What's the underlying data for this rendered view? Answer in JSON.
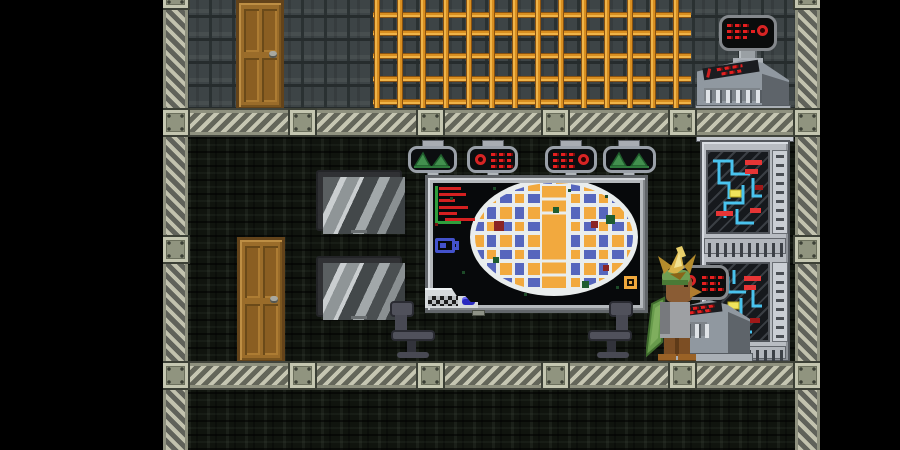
{
  "window": {
    "kind": "pixel-art sandbox game scene",
    "scene_label": "Space station interior with planetary map room",
    "canvas": {
      "width": 900,
      "height": 450
    }
  },
  "palette": {
    "space_black": "#000000",
    "hull_wall_gray": "#3d4446",
    "cave_rock_dark": "#10140e",
    "beam_stripe_light": "#c6c6b2",
    "beam_stripe_dark": "#64665a",
    "rivet_plate_gray": "#90947f",
    "lattice_copper": "#d88e20",
    "lattice_highlight": "#f0b448",
    "door_wood": "#9a6c2a",
    "map_frame_gray": "#b4b8bc",
    "planet_orange": "#f2a93e",
    "planet_blue": "#5666bd",
    "planet_rim_white": "#e9eded",
    "display_red": "#e41f1f",
    "display_green": "#42904e",
    "circuit_blue": "#49c3ee",
    "circuit_yellow": "#f0e45c",
    "chair_slate": "#484953",
    "npc_gold_plume": "#d9b349",
    "npc_green_cape": "#689b4c",
    "npc_brown_skin": "#8a5c34"
  },
  "entities": [
    {
      "name": "hull-wall",
      "label": "Hull plating wall (upper deck)",
      "interactable": false
    },
    {
      "name": "cave-wall-room",
      "label": "Dark rock wall (map room)",
      "interactable": false
    },
    {
      "name": "cave-wall-basement",
      "label": "Dark rock wall (lower level)",
      "interactable": false
    },
    {
      "name": "beam-upper",
      "label": "Riveted support beam (upper floor)",
      "interactable": false
    },
    {
      "name": "beam-lower",
      "label": "Riveted support beam (lower floor)",
      "interactable": false
    },
    {
      "name": "column-left",
      "label": "Support column (left)",
      "interactable": false
    },
    {
      "name": "column-right",
      "label": "Support column (right)",
      "interactable": false
    },
    {
      "name": "lattice-grid",
      "label": "Copper lattice grid",
      "interactable": false
    },
    {
      "name": "door-upper",
      "label": "Wooden door (upper deck)",
      "interactable": true
    },
    {
      "name": "door-lower",
      "label": "Wooden door (map room)",
      "interactable": true
    },
    {
      "name": "monitor-upper",
      "label": "Wall monitor (upper)",
      "interactable": false
    },
    {
      "name": "monitor-lower",
      "label": "Wall monitor (lower)",
      "interactable": false
    },
    {
      "name": "map-display",
      "label": "Planetary survey map display",
      "interactable": true
    },
    {
      "name": "pod-green-left",
      "label": "Scanner pod - green waveform (far left)",
      "interactable": false
    },
    {
      "name": "pod-red-left",
      "label": "Scanner pod - red readout (inner left)",
      "interactable": false
    },
    {
      "name": "pod-red-right",
      "label": "Scanner pod - red readout (inner right)",
      "interactable": false
    },
    {
      "name": "pod-green-right",
      "label": "Scanner pod - green waveform (far right)",
      "interactable": false
    },
    {
      "name": "console-upper",
      "label": "Computer console with red readout (upper deck)",
      "interactable": true
    },
    {
      "name": "console-lower",
      "label": "Computer console with red readout (map room)",
      "interactable": true
    },
    {
      "name": "server-rack",
      "label": "Server rack with blue circuitry",
      "interactable": false
    },
    {
      "name": "chair-left",
      "label": "Office chair (left, facing right)",
      "interactable": true
    },
    {
      "name": "chair-right",
      "label": "Office chair (right, facing left)",
      "interactable": true
    },
    {
      "name": "avian-npc",
      "label": "Avian crew member with gold plume at console",
      "interactable": true
    },
    {
      "name": "void-left",
      "label": "Empty space (left)",
      "interactable": false
    },
    {
      "name": "void-right",
      "label": "Empty space (right)",
      "interactable": false
    }
  ],
  "map_display": {
    "planet": {
      "shape": "ellipse",
      "rim_color": "#e9eded",
      "cell_colors": [
        "#f2a93e",
        "#5666bd"
      ],
      "center_block_color": "#f2a93e",
      "anomaly_cells": [
        "#8a2424",
        "#1e5c30"
      ]
    },
    "hud": {
      "green_axis": true,
      "red_bar_count": 6,
      "camera_icon_color": "#4352cc",
      "corner_checker_strip": true,
      "blue_pill_button": "#2a2ac0",
      "orange_waypoint_marker": "#f0a83c"
    }
  }
}
